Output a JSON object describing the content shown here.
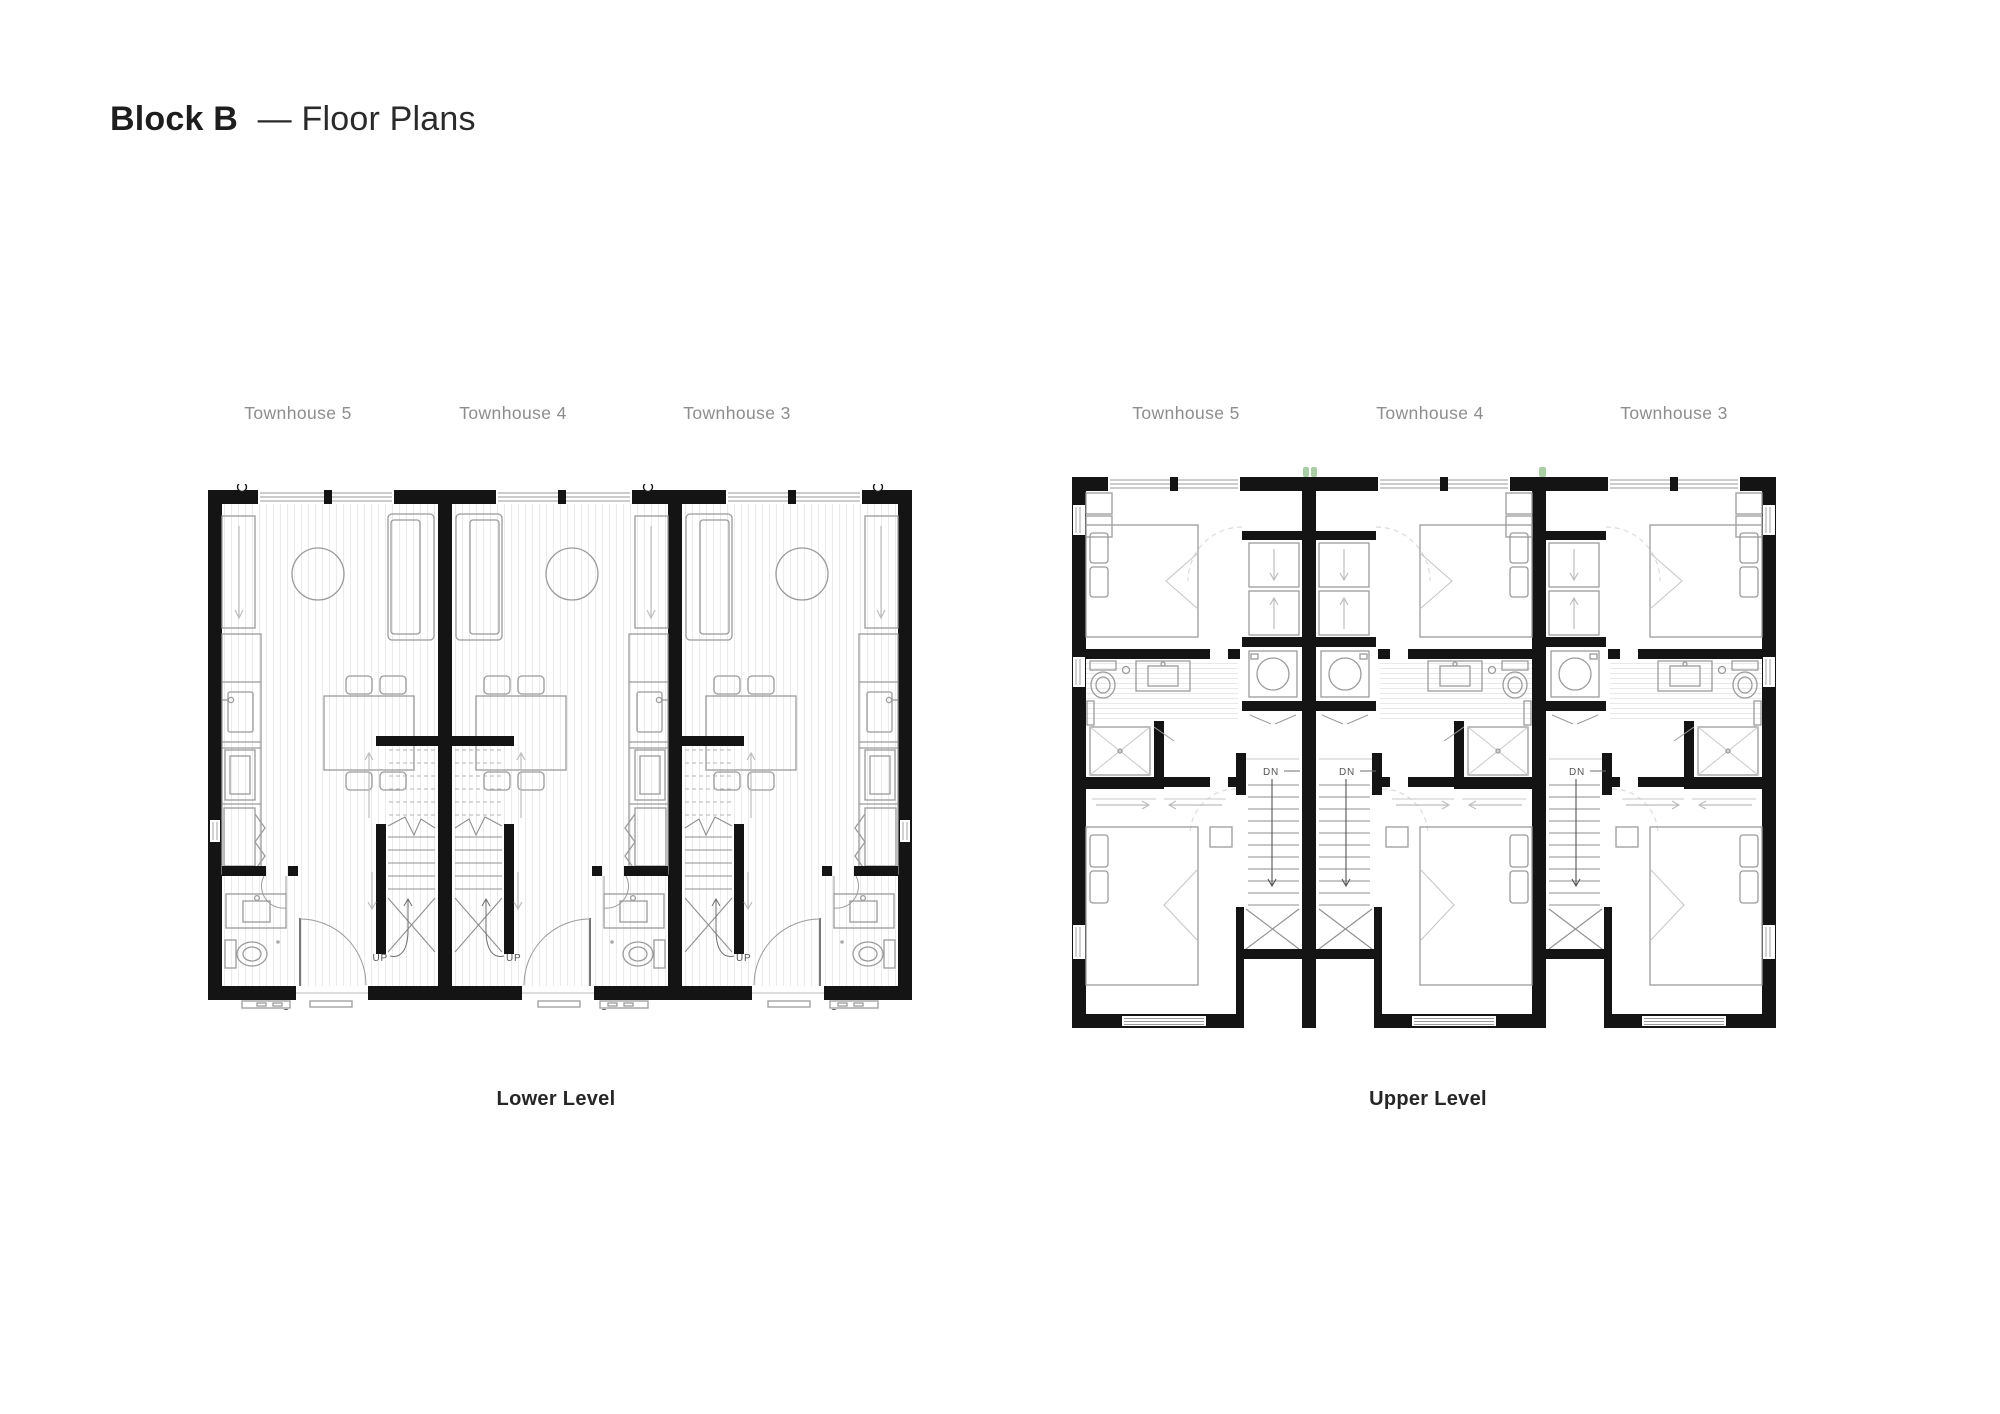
{
  "title": {
    "bold": "Block B",
    "rest": "— Floor Plans"
  },
  "lower": {
    "caption": "Lower Level",
    "stair_label": "UP",
    "units": [
      {
        "label": "Townhouse 5"
      },
      {
        "label": "Townhouse 4"
      },
      {
        "label": "Townhouse 3"
      }
    ]
  },
  "upper": {
    "caption": "Upper Level",
    "stair_label": "DN",
    "units": [
      {
        "label": "Townhouse 5"
      },
      {
        "label": "Townhouse 4"
      },
      {
        "label": "Townhouse 3"
      }
    ]
  },
  "colors": {
    "wall": "#141414",
    "furniture_line": "#9b9b9b",
    "floor_hatch": "#ebebeb",
    "label_gray": "#8d8d8d",
    "plant_green": "#a9cda5",
    "text_dark": "#262626"
  }
}
